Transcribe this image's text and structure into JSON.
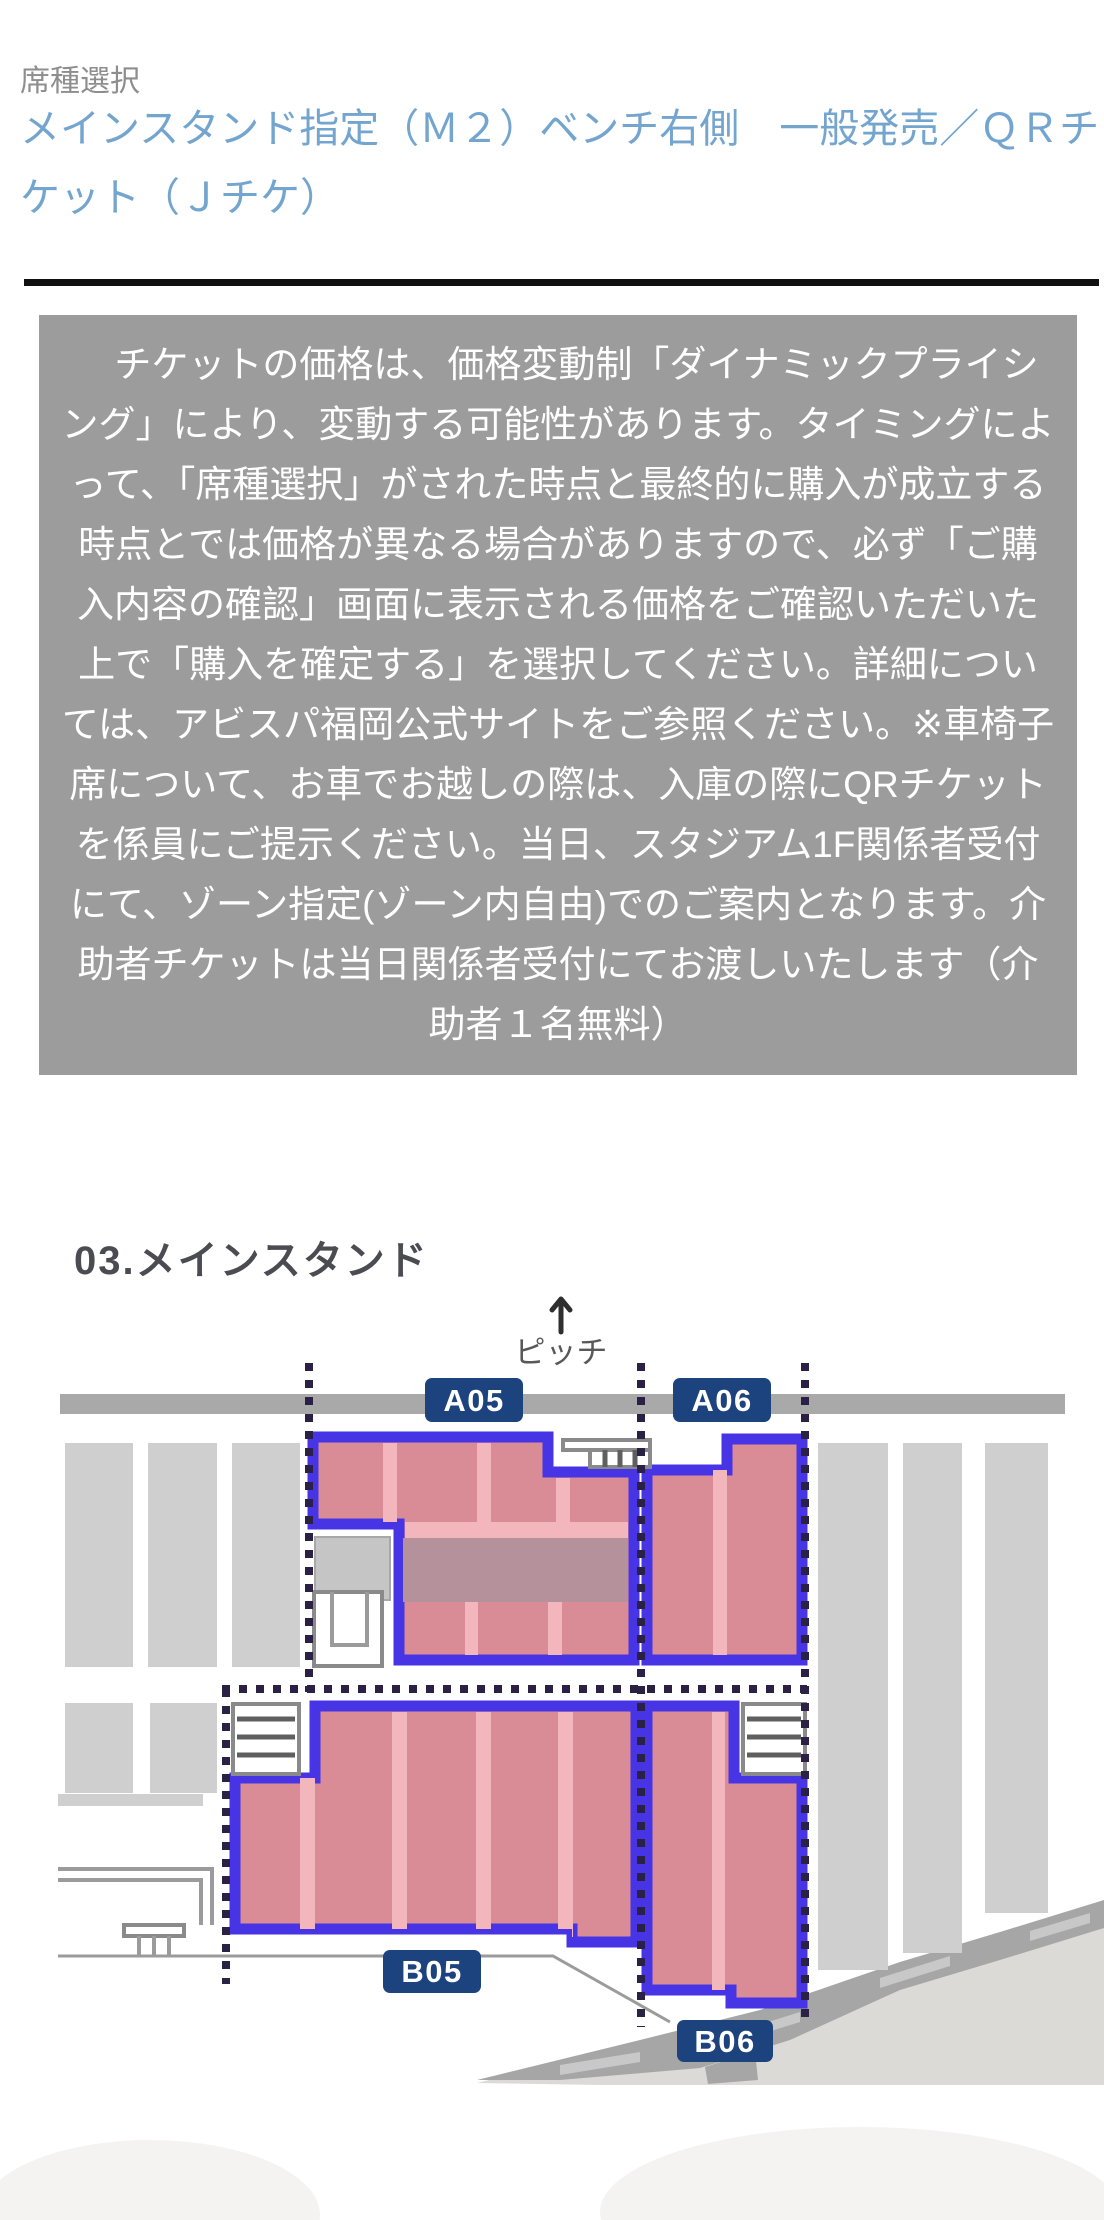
{
  "header": {
    "section_label": "席種選択",
    "title": "メインスタンド指定（Ｍ２）ベンチ右側　一般発売／ＱＲチケット（Ｊチケ）"
  },
  "notice": {
    "text": "　チケットの価格は、価格変動制「ダイナミックプライシング」により、変動する可能性があります。タイミングによって、「席種選択」がされた時点と最終的に購入が成立する時点とでは価格が異なる場合がありますので、必ず「ご購入内容の確認」画面に表示される価格をご確認いただいた上で「購入を確定する」を選択してください。詳細については、アビスパ福岡公式サイトをご参照ください。※車椅子席について、お車でお越しの際は、入庫の際にQRチケットを係員にご提示ください。当日、スタジアム1F関係者受付にて、ゾーン指定(ゾーン内自由)でのご案内となります。介助者チケットは当日関係者受付にてお渡しいたします（介助者１名無料）"
  },
  "map": {
    "title": "03.メインスタンド",
    "pitch_label": "ピッチ",
    "areas": [
      {
        "label": "A05"
      },
      {
        "label": "A06"
      },
      {
        "label": "B05"
      },
      {
        "label": "B06"
      }
    ]
  },
  "colors": {
    "heading_blue": "#74a5cf",
    "section_label_gray": "#8e8e8e",
    "divider_black": "#101010",
    "notice_bg": "#9c9c9c",
    "notice_text": "#ffffff",
    "area_label_navy": "#1d437f",
    "seat_fill_pink": "#d98b96",
    "seat_aisle_pink": "#f2b6bc",
    "seat_muted_band": "#b5929b",
    "seat_border_blue": "#4634e5",
    "walkway_gray": "#a9a9a9",
    "other_block_gray": "#cfcfcf",
    "dotted_line_navy": "#2a2144",
    "road_gray": "#a6a6a6"
  }
}
